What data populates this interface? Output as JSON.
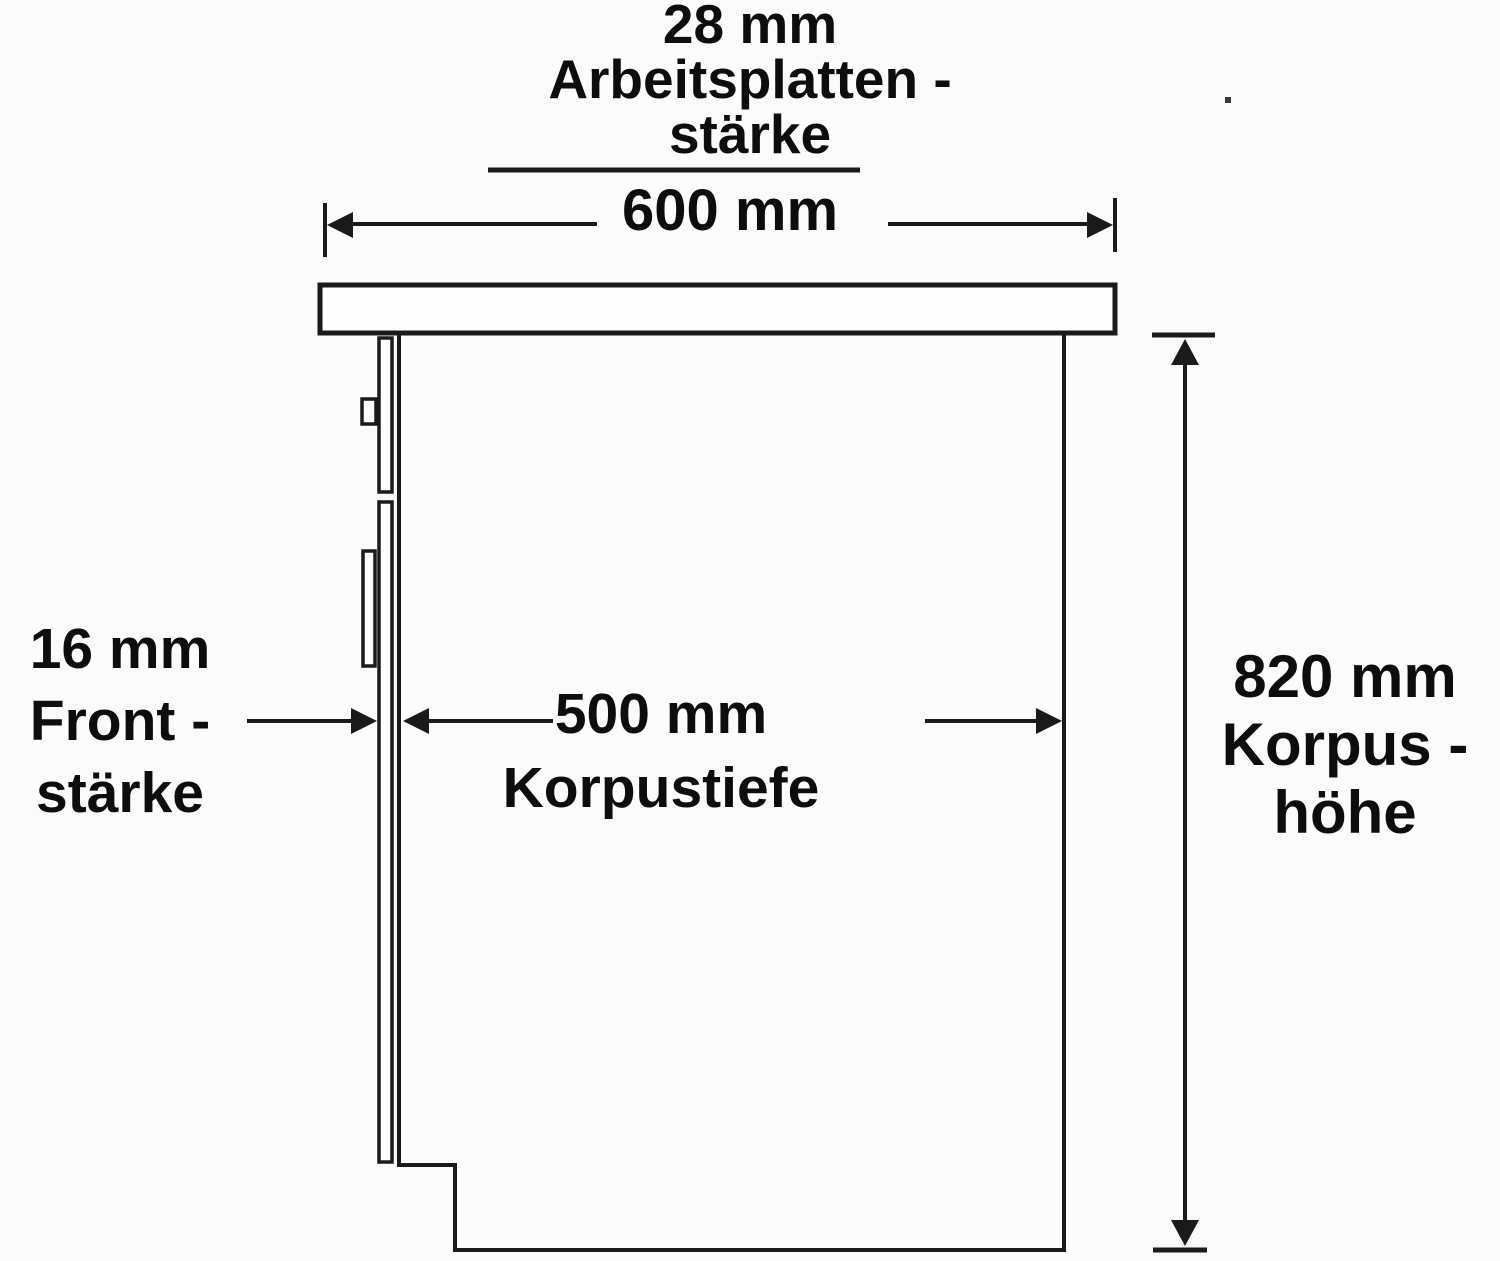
{
  "theme": {
    "background_color": "#fbfbfb",
    "line_color": "#1a1a1a",
    "text_color": "#0d0d0d"
  },
  "diagram": {
    "type": "kitchen-base-cabinet-side-section",
    "labels": {
      "worktop_thickness": {
        "line1": "28 mm",
        "line2": "Arbeitsplatten -",
        "line3": "stärke"
      },
      "cabinet_width": {
        "value": "600 mm"
      },
      "front_thickness": {
        "line1": "16 mm",
        "line2": "Front -",
        "line3": "stärke"
      },
      "body_depth": {
        "line1": "500 mm",
        "line2": "Korpustiefe"
      },
      "body_height": {
        "line1": "820 mm",
        "line2": "Korpus -",
        "line3": "höhe"
      }
    }
  }
}
